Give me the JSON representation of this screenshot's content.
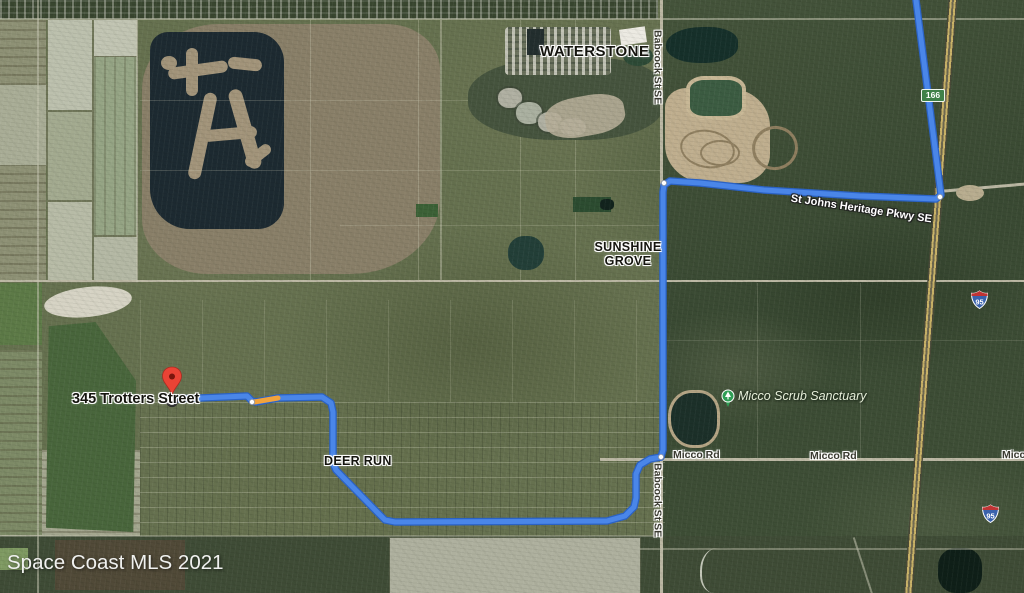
{
  "watermark": "Space Coast MLS 2021",
  "destination": {
    "address": "345 Trotters Street"
  },
  "places": {
    "waterstone": "WATERSTONE",
    "sunshine_grove_line1": "SUNSHINE",
    "sunshine_grove_line2": "GROVE",
    "deer_run": "DEER RUN",
    "micco_scrub_sanctuary": "Micco Scrub Sanctuary"
  },
  "roads": {
    "babcock_north": "Babcock St SE",
    "babcock_south": "Babcock St SE",
    "heritage_pkwy": "St Johns Heritage Pkwy SE",
    "micco_rd_west": "Micco Rd",
    "micco_rd_east": "Micco Rd",
    "micco_rd_edge": "Micco",
    "exit_marker": "166",
    "i95_shield_north": "95",
    "i95_shield_south": "95"
  },
  "route": {
    "blue_points": "177,399 247,396 252,401 256,402 278,398 322,397 331,403 333,412 333,463 336,470 378,513 385,520 395,522 607,521 625,516 634,507 636,498 636,474 640,465 650,459 661,457 663,450 663,192 664,185 670,181 700,183 764,190 860,196 936,199 941,195 916,0",
    "traffic_points": "254,402 266,400 278,398",
    "waypoint_dots": [
      [
        252,
        402
      ],
      [
        661,
        457
      ],
      [
        664,
        183
      ],
      [
        940,
        197
      ]
    ]
  },
  "colors": {
    "route_blue": "#4a86e8",
    "route_casing": "#2b62c4",
    "traffic_orange": "#f2a33c",
    "destination_pin_red": "#ea4335",
    "park_pin_green": "#2f9e55",
    "exit_badge_green": "#3f8048",
    "shield_blue": "#3a62ac",
    "shield_red": "#bf3434"
  }
}
